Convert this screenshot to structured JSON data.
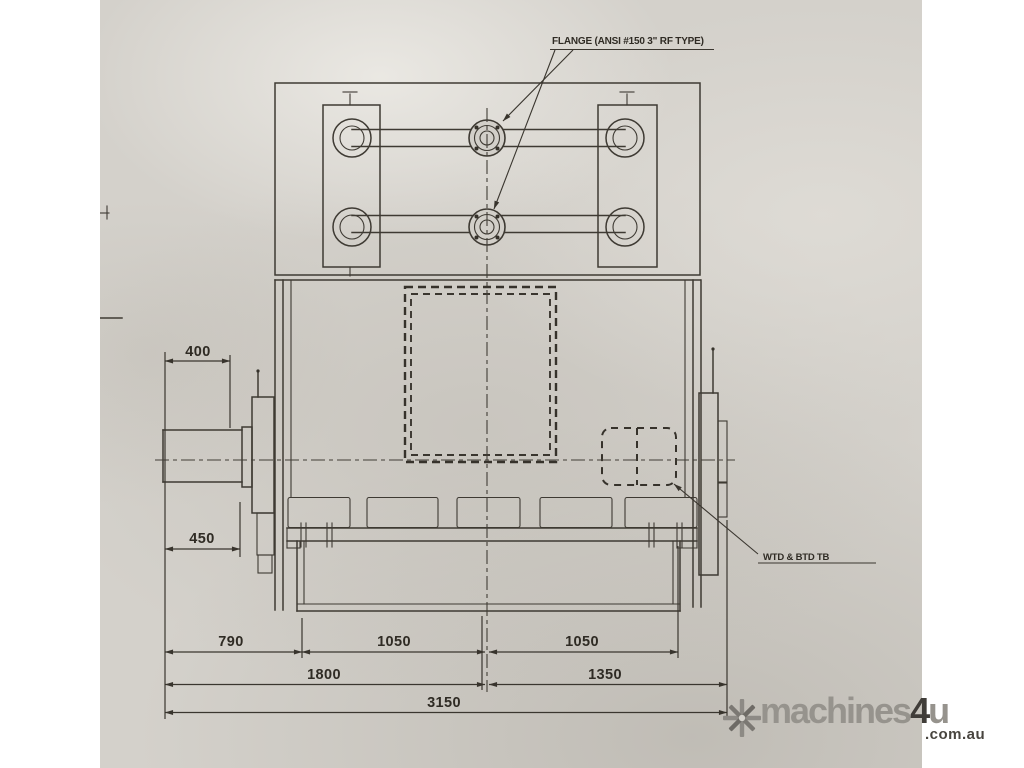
{
  "drawing": {
    "flange_label": "FLANGE (ANSI #150 3\" RF TYPE)",
    "terminal_label": "WTD & BTD TB",
    "dimensions": {
      "shaft_extension": "400",
      "shaft_to_face": "450",
      "row1": [
        "790",
        "1050",
        "1050"
      ],
      "row2": [
        "1800",
        "1350"
      ],
      "overall": "3150"
    }
  },
  "watermark": {
    "icon": "snowflake-asterisk",
    "brand_main": "machines",
    "brand_accent": "4",
    "brand_suffix": "u",
    "brand_domain": ".com.au"
  },
  "colors": {
    "paper": "#d4d1cb",
    "ink": "#3e3a33",
    "watermark_gray": "#96938d",
    "watermark_dark": "#403d39"
  }
}
